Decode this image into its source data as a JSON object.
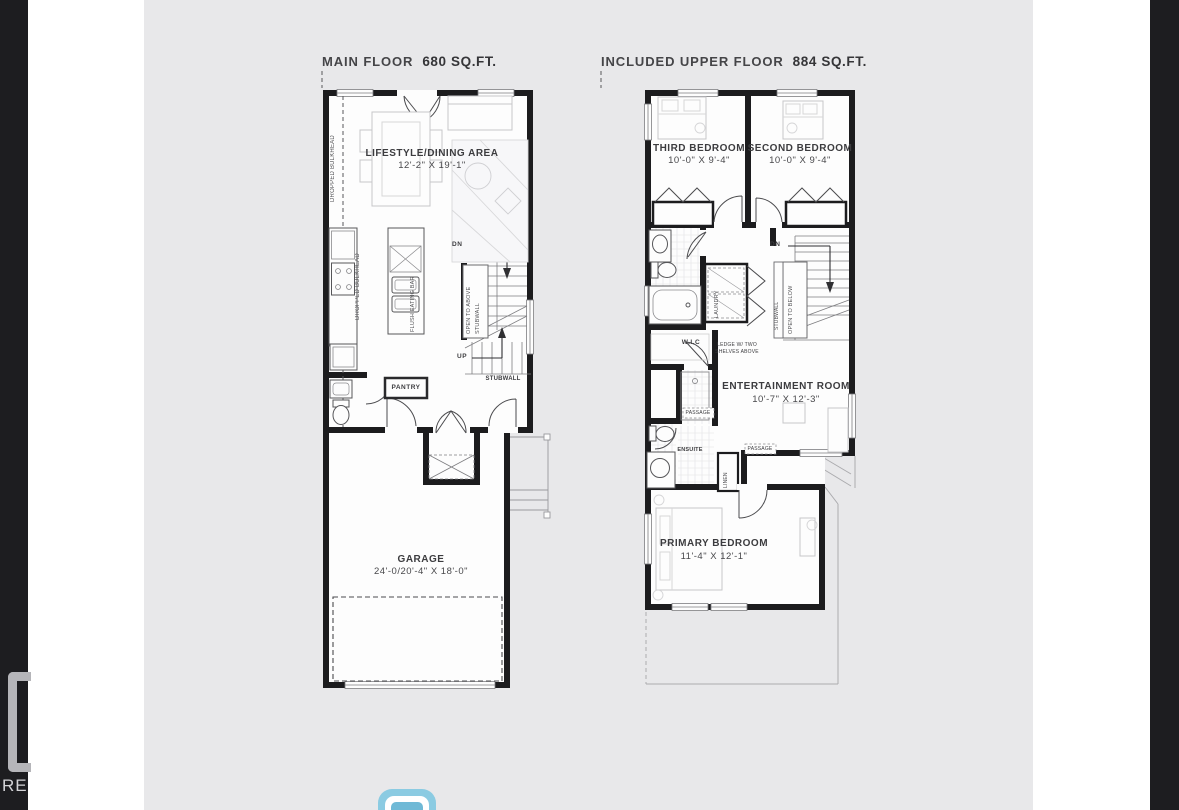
{
  "colors": {
    "panel_bg": "#e8e8ea",
    "edge_strip": "#1d1d20",
    "wall": "#1c1c1e",
    "title_text": "#454548",
    "icon_blue": "#8bcbe2",
    "icon_blue_inner": "#6fb9d6"
  },
  "plans": {
    "main": {
      "title": "MAIN FLOOR",
      "area": "680 SQ.FT.",
      "rooms": {
        "lifestyle": {
          "name": "LIFESTYLE/DINING AREA",
          "dims": "12'-2\" X 19'-1\""
        },
        "garage": {
          "name": "GARAGE",
          "dims": "24'-0/20'-4\" X 18'-0\""
        },
        "pantry": {
          "name": "PANTRY"
        }
      },
      "annotations": {
        "dropped_bulkhead": "DROPPED BULKHEAD",
        "flush_eating_bar": "FLUSH EATING BAR",
        "open_to_above": "OPEN TO ABOVE",
        "stubwall": "STUBWALL",
        "dn": "DN",
        "up": "UP"
      }
    },
    "upper": {
      "title": "INCLUDED UPPER FLOOR",
      "area": "884 SQ.FT.",
      "rooms": {
        "third_bedroom": {
          "name": "THIRD BEDROOM",
          "dims": "10'-0\" X 9'-4\""
        },
        "second_bedroom": {
          "name": "SECOND BEDROOM",
          "dims": "10'-0\" X 9'-4\""
        },
        "entertainment": {
          "name": "ENTERTAINMENT ROOM",
          "dims": "10'-7\" X 12'-3\""
        },
        "primary_bedroom": {
          "name": "PRIMARY BEDROOM",
          "dims": "11'-4\" X 12'-1\""
        },
        "wic": {
          "name": "W.I.C"
        },
        "ensuite": {
          "name": "ENSUITE"
        },
        "laundry": {
          "name": "LAUNDRY"
        },
        "linen": {
          "name": "LINEN"
        }
      },
      "annotations": {
        "dn": "DN",
        "stubwall": "STUBWALL",
        "open_to_below": "OPEN TO BELOW",
        "passage": "PASSAGE",
        "shelf_note_line1": "LEDGE W/ TWO",
        "shelf_note_line2": "SHELVES ABOVE"
      }
    }
  },
  "watermark": {
    "partial_text": "RE"
  }
}
